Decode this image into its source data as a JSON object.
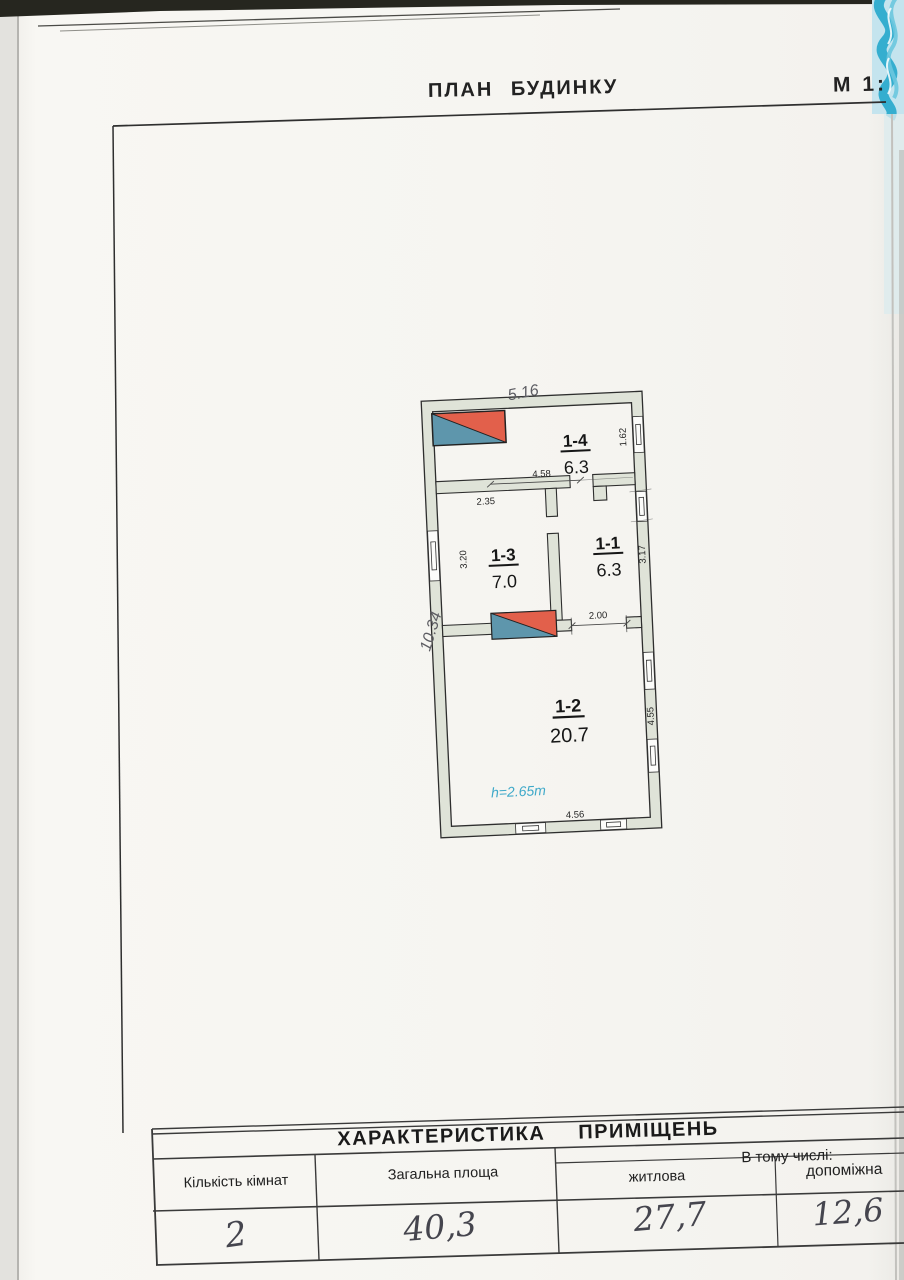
{
  "page": {
    "title": "ПЛАН БУДИНКУ",
    "scale": "М 1:"
  },
  "plan": {
    "handwritten_width": "5.16",
    "handwritten_height": "10.34",
    "ceiling_height": "h=2.65m",
    "rooms": [
      {
        "id": "1-4",
        "area": "6.3"
      },
      {
        "id": "1-3",
        "area": "7.0"
      },
      {
        "id": "1-1",
        "area": "6.3"
      },
      {
        "id": "1-2",
        "area": "20.7"
      }
    ],
    "dims": {
      "hall_width": "4.58",
      "room13_width": "2.35",
      "window14": "1.62",
      "room13_depth": "3.20",
      "room11_depth": "3.17",
      "door12_width": "2.00",
      "room12_depth": "4.55",
      "room12_width": "4.56"
    }
  },
  "table": {
    "title": "ХАРАКТЕРИСТИКА ПРИМІЩЕНЬ",
    "including": "В тому числі:",
    "columns": {
      "rooms": "Кількість кімнат",
      "total": "Загальна площа",
      "living": "житлова",
      "auxiliary": "допоміжна"
    },
    "values": {
      "rooms": "2",
      "total": "40,3",
      "living": "27,7",
      "auxiliary": "12,6"
    }
  },
  "colors": {
    "stove_red": "#e2604b",
    "stove_blue": "#5e96ac",
    "note_cyan": "#3fa9c9",
    "pattern_blue": "#35aecf",
    "wall_fill": "#dfe3d8"
  }
}
